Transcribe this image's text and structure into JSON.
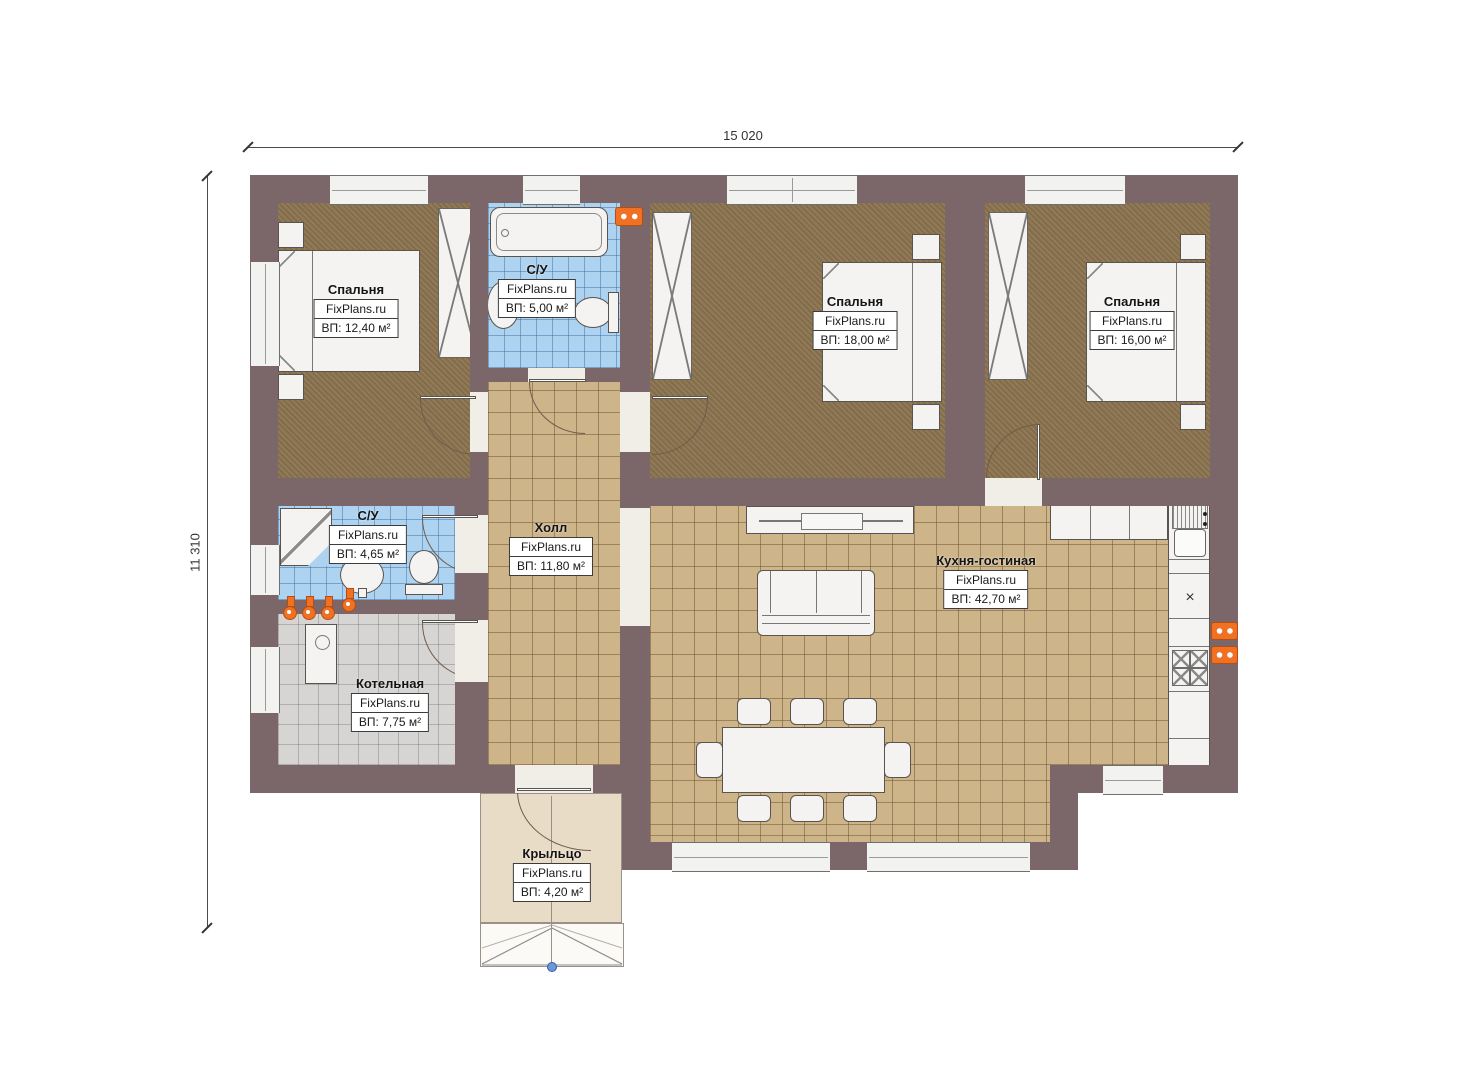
{
  "dims": {
    "width_label": "15 020",
    "height_label": "11 310"
  },
  "watermark": "FixPlans.ru",
  "rooms": [
    {
      "id": "bedroom-1",
      "name": "Спальня",
      "brand": "FixPlans.ru",
      "area": "ВП: 12,40 м²"
    },
    {
      "id": "bathroom-top",
      "name": "С/У",
      "brand": "FixPlans.ru",
      "area": "ВП: 5,00 м²"
    },
    {
      "id": "bedroom-2",
      "name": "Спальня",
      "brand": "FixPlans.ru",
      "area": "ВП: 18,00 м²"
    },
    {
      "id": "bedroom-3",
      "name": "Спальня",
      "brand": "FixPlans.ru",
      "area": "ВП: 16,00 м²"
    },
    {
      "id": "bathroom-mid",
      "name": "С/У",
      "brand": "FixPlans.ru",
      "area": "ВП: 4,65 м²"
    },
    {
      "id": "hall",
      "name": "Холл",
      "brand": "FixPlans.ru",
      "area": "ВП: 11,80 м²"
    },
    {
      "id": "kitchen-living",
      "name": "Кухня-гостиная",
      "brand": "FixPlans.ru",
      "area": "ВП: 42,70 м²"
    },
    {
      "id": "boiler",
      "name": "Котельная",
      "brand": "FixPlans.ru",
      "area": "ВП: 7,75 м²"
    },
    {
      "id": "porch",
      "name": "Крыльцо",
      "brand": "FixPlans.ru",
      "area": "ВП: 4,20 м²"
    }
  ],
  "colors": {
    "wall": "#7b6769",
    "bedroom_carpet": "#8b734e",
    "tile_tan": "#cdb489",
    "tile_blue": "#aed3f0",
    "tile_gray": "#d6d5d3",
    "porch": "#e9dcc6",
    "accent_orange": "#f07024",
    "fixture_white": "#f4f3f1"
  }
}
